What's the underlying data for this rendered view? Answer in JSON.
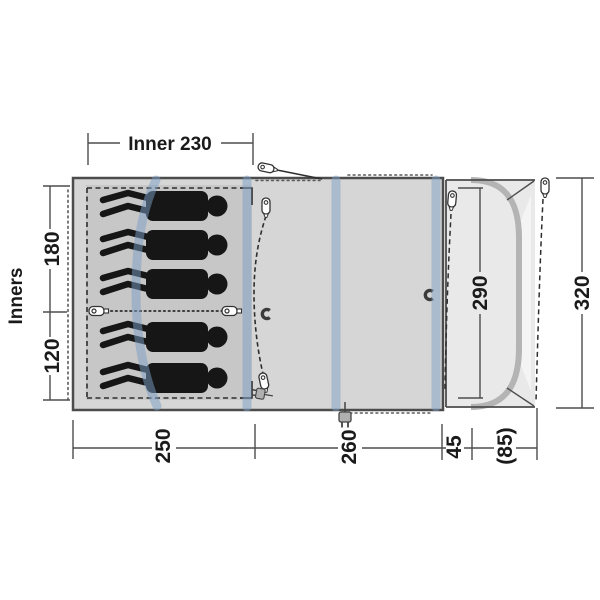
{
  "diagram_title": "tent-floorplan-top-view",
  "dimensions": {
    "inner_width": "Inner 230",
    "inners_label": "Inners",
    "inner_section_top": "180",
    "inner_section_bottom": "120",
    "bedroom_depth": "250",
    "living_depth": "260",
    "canopy_flat_depth": "45",
    "canopy_total_depth": "(85)",
    "front_opening_width": "290",
    "total_width": "320"
  },
  "figures": {
    "count": 5,
    "description": "sleeping person silhouettes"
  },
  "icons": [
    "tent-peg-icon",
    "toggle-icon",
    "magnet-icon",
    "power-plug-icon",
    "pole-sleeve",
    "flexible-pole"
  ],
  "colors": {
    "tent_body": "#d5d6d5",
    "inner_tent": "#c6c7c6",
    "porch": "#e9e9e9",
    "porch_open": "#f4f4f4",
    "pole_sleeve_blue": "#7d9fc6",
    "steel_pole_gray": "#b4b4b4",
    "outline": "#4c4c4c",
    "figure": "#161616"
  }
}
